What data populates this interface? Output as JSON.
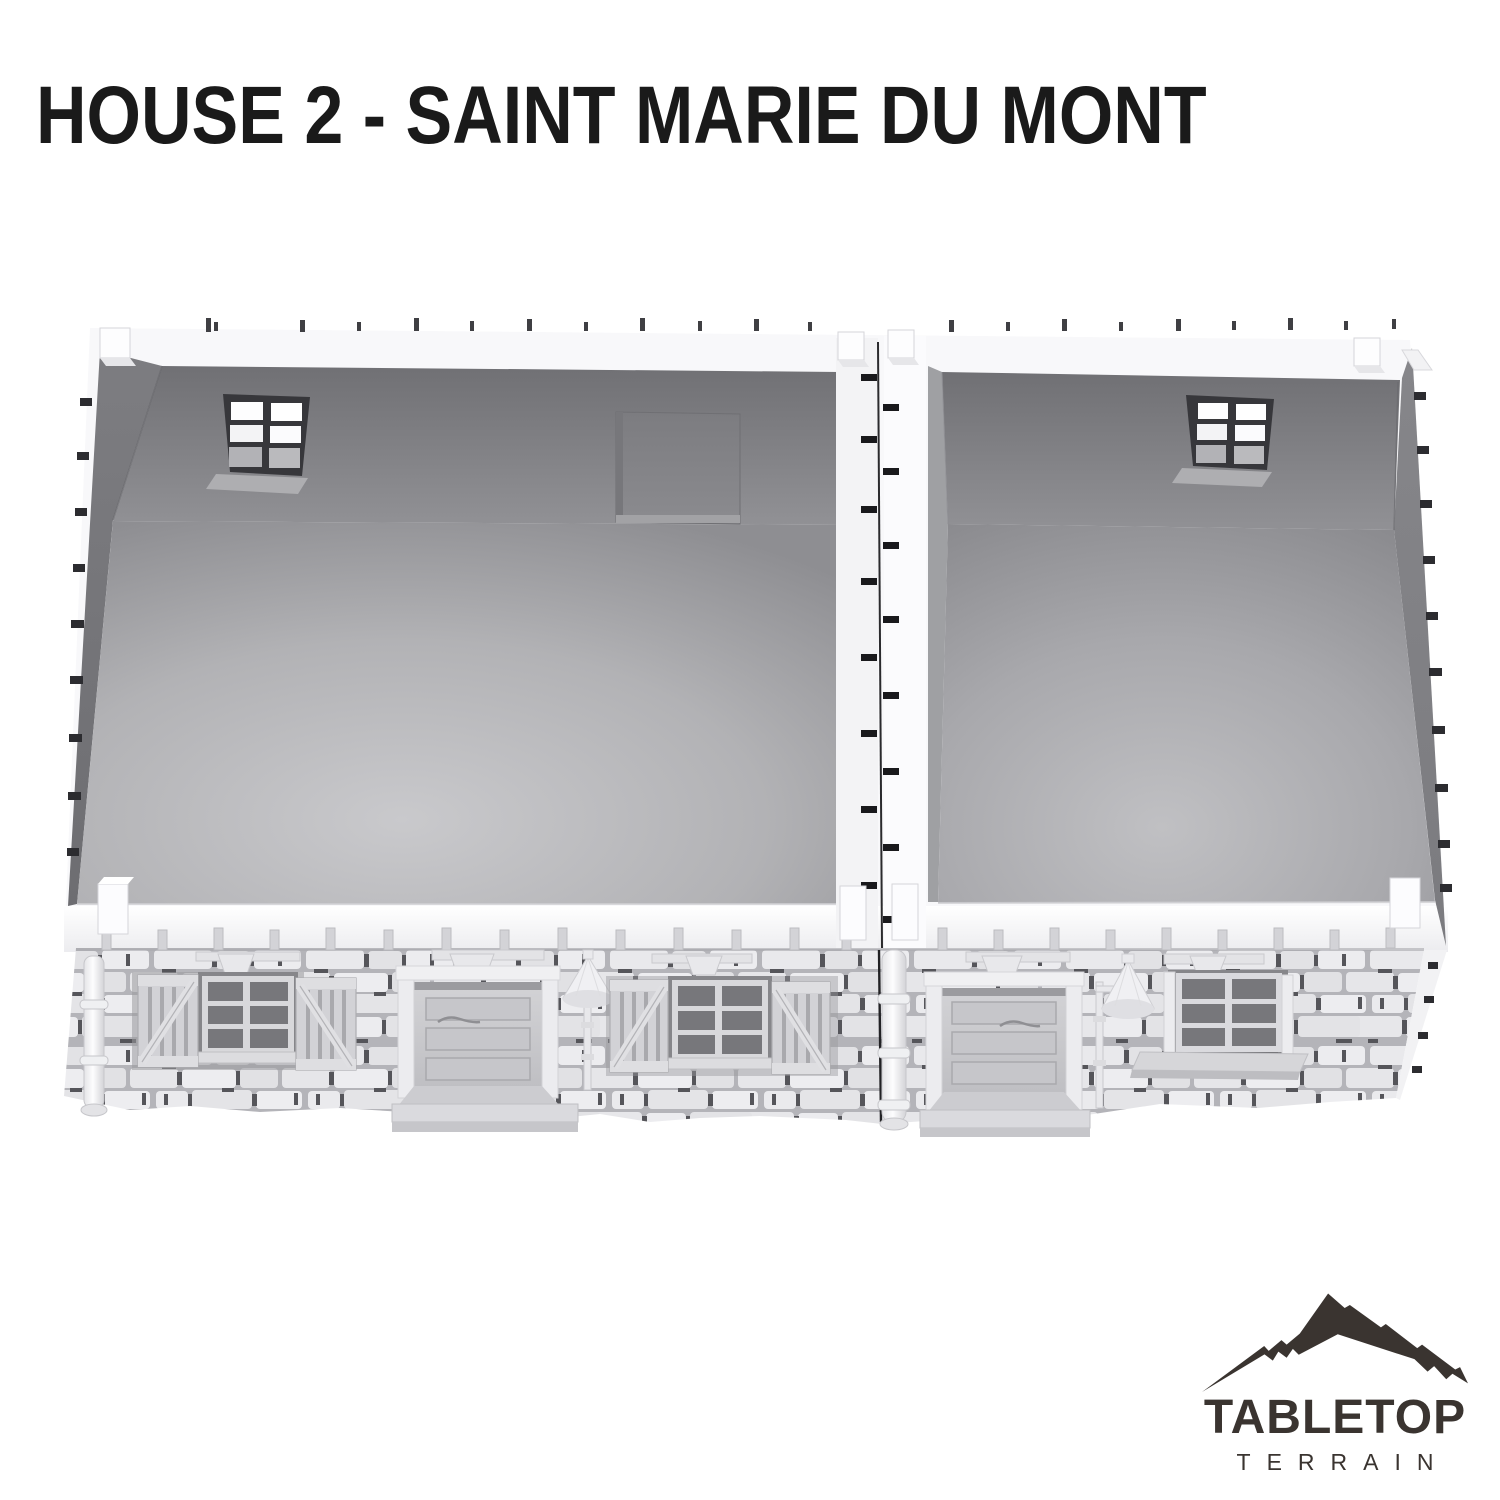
{
  "page": {
    "title": "HOUSE 2 - SAINT MARIE DU MONT"
  },
  "render": {
    "alt": "Top-down 3D render of a two-room stone house miniature with open roof, rear six-pane windows, fireplace alcove, stone facade with two plank doors on stone steps, shuttered windows, a sill window, wall lamps and drainpipes"
  },
  "logo": {
    "brand_top": "TABLETOP",
    "brand_bottom": "TERRAIN"
  },
  "colors": {
    "background": "#ffffff",
    "title_text": "#1a1a1a",
    "logo_ink": "#3a3430",
    "plastic_white": "#f8f8fa",
    "interior_wall_dark": "#707074",
    "interior_wall_mid": "#909094",
    "interior_floor_light": "#c9c9cc",
    "stone_light": "#e9e9ec",
    "stone_mortar": "#b4b4b9",
    "stone_gap_dark": "#55555a",
    "seam_dark": "#1c1c1f"
  }
}
